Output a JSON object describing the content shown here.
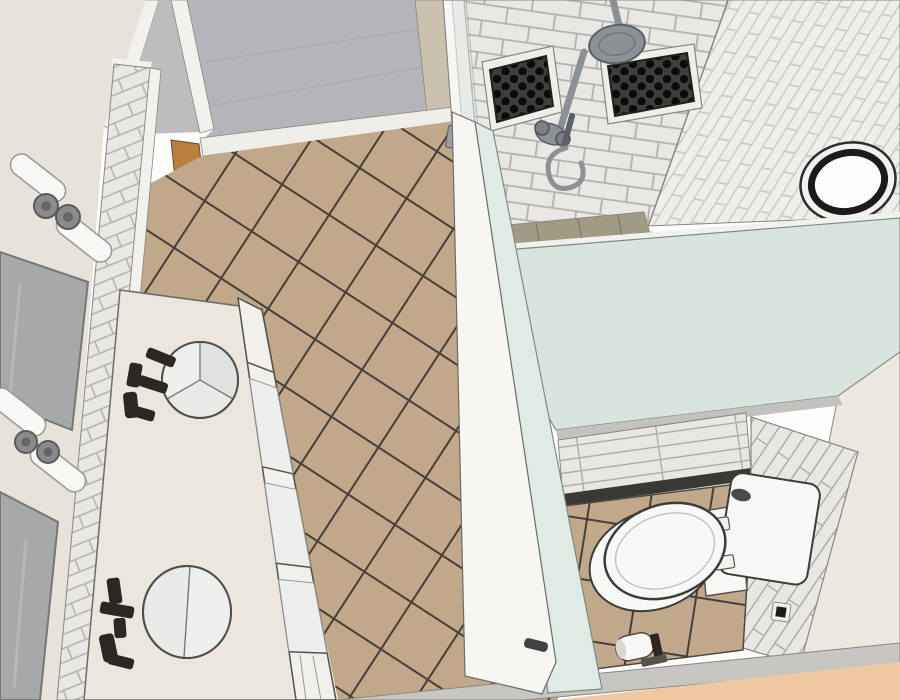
{
  "scene": {
    "title": "3D overhead render of a bathroom (orbit view)",
    "room": "bathroom",
    "view": "overhead-orbit-3d",
    "objects": [
      "entry-doorway",
      "hallway-floor",
      "vanity-wall",
      "vanity-sconce-upper",
      "vanity-sconce-lower",
      "vanity-mirror-upper",
      "vanity-mirror-lower",
      "subway-tile-wainscot-strip",
      "vanity-countertop",
      "vessel-sink-upper",
      "vessel-sink-lower",
      "wall-faucet-upper",
      "wall-faucet-lower",
      "vanity-open-shelving",
      "main-floor-tan-tile",
      "shower-back-wall-subway-tile",
      "shower-niche-left",
      "shower-niche-right",
      "rain-shower-head",
      "shower-slide-bar",
      "hand-shower-hose",
      "shower-curb",
      "glass-fixed-panel",
      "glass-shower-door",
      "door-handle",
      "glass-pony-wall",
      "toilet-nook-floor",
      "toilet",
      "toilet-tank",
      "toilet-paper-holder",
      "electrical-outlet",
      "nook-plank-wall",
      "round-wall-mirror",
      "stacked-tile-wall",
      "baseboard",
      "adjacent-wood-floor",
      "wood-threshold"
    ]
  },
  "colors": {
    "bg": "#fdfdfd",
    "edge": "#4c4945",
    "edge_soft": "#8a8783",
    "wall_cream": "#e8e3da",
    "wall_cream_light": "#ece8e0",
    "counter_cream": "#ebe6de",
    "trim_white": "#f3f1ed",
    "door_white": "#f7f6f3",
    "hall_wall_gray": "#c6c7c9",
    "hall_floor_gray": "#b4b5b8",
    "hall_gap_gray": "#bcbdbf",
    "hall_plank_line": "#a9aaad",
    "mirror_gray": "#a7a8aa",
    "mirror_glare": "#bdbec0",
    "tile_white": "#eae8e4",
    "grout_light": "#b3b1ad",
    "vtile_white": "#f0eeeb",
    "vtile_grout": "#ccc9c5",
    "plank_white": "#e9e7e3",
    "plank_line": "#a5a39f",
    "floor_tan": "#c1a88b",
    "grout_tan": "#453f38",
    "olive_tile": "#a29b84",
    "olive_line": "#7e785f",
    "niche_bg": "#403e3a",
    "niche_dot": "#0b0b0a",
    "niche_trim": "#f0eee9",
    "fixture_gray": "#8c9195",
    "fixture_dark": "#5d6165",
    "metal_gray": "#9aa0a4",
    "glass_mint": "#d8e4de",
    "glass_mint_light": "#e0ebe5",
    "glass_edge": "#7e8a84",
    "beige_wall": "#cbc1af",
    "wood": "#bb7f40",
    "wood_edge": "#6b4a23",
    "porcelain": "#f8f8f6",
    "porcelain_line": "#c6c4c0",
    "sink_fill": "#e9ebe9",
    "sink_light": "#eef0ee",
    "sink_mid": "#dfe2e0",
    "sink_line": "#7a7874",
    "faucet_black": "#2b2722",
    "dark_gap": "#3a3835",
    "wall_top_gray": "#c3c2be",
    "baseboard": "#c7c6c2",
    "peach": "#efc9a1",
    "outlet_dark": "#1d1c1a",
    "threshold_white": "#f0eee9",
    "shelf_box": "#edefee",
    "shelf_panel": "#f2f0ec",
    "tank_button": "#4b4a47",
    "handle_dark": "#3f4440"
  }
}
